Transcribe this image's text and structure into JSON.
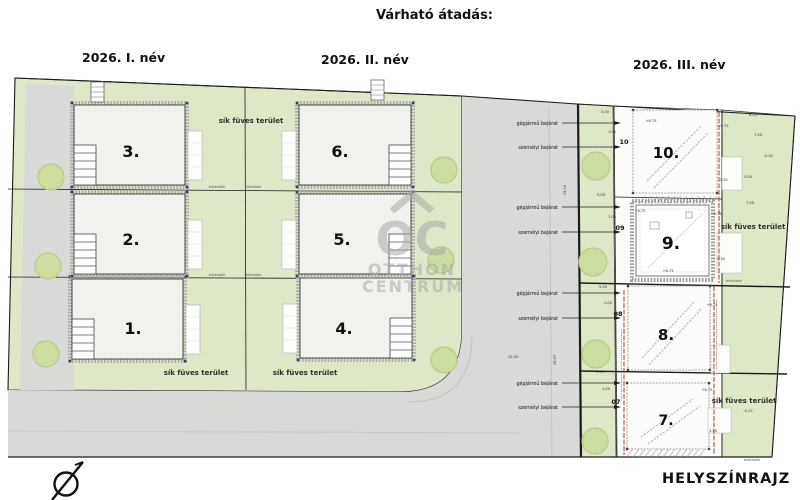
{
  "header": {
    "title": "Várható átadás:",
    "quarters": [
      {
        "label": "2026. I. név"
      },
      {
        "label": "2026. II. név"
      },
      {
        "label": "2026. III. név"
      }
    ]
  },
  "footer": {
    "drawing_type": "HELYSZÍNRAJZ"
  },
  "watermark": {
    "initials": "OC",
    "line1": "OTTHON",
    "line2": "CENTRUM"
  },
  "plan": {
    "grass_label": "sík füves terület",
    "boundary_label": "telekhatár",
    "buildings": [
      {
        "label": "1.",
        "x": 133,
        "y": 334,
        "fs": 16
      },
      {
        "label": "2.",
        "x": 131,
        "y": 245,
        "fs": 16
      },
      {
        "label": "3.",
        "x": 131,
        "y": 157,
        "fs": 16
      },
      {
        "label": "4.",
        "x": 344,
        "y": 334,
        "fs": 16
      },
      {
        "label": "5.",
        "x": 342,
        "y": 245,
        "fs": 16
      },
      {
        "label": "6.",
        "x": 340,
        "y": 157,
        "fs": 16
      },
      {
        "label": "7.",
        "x": 666,
        "y": 425,
        "fs": 14
      },
      {
        "label": "8.",
        "x": 666,
        "y": 340,
        "fs": 15
      },
      {
        "label": "9.",
        "x": 671,
        "y": 249,
        "fs": 17
      },
      {
        "label": "10.",
        "x": 666,
        "y": 158,
        "fs": 15
      }
    ],
    "plot_markers": [
      {
        "label": "10",
        "x": 624,
        "y": 144
      },
      {
        "label": "09",
        "x": 620,
        "y": 230
      },
      {
        "label": "08",
        "x": 618,
        "y": 316
      },
      {
        "label": "07",
        "x": 616,
        "y": 404
      }
    ],
    "entrances": [
      {
        "label": "gépjármű bejárat",
        "y": 123
      },
      {
        "label": "személyi bejárat",
        "y": 147
      },
      {
        "label": "gépjármű bejárat",
        "y": 207
      },
      {
        "label": "személyi bejárat",
        "y": 232
      },
      {
        "label": "gépjármű bejárat",
        "y": 293
      },
      {
        "label": "személyi bejárat",
        "y": 318
      },
      {
        "label": "gépjármű bejárat",
        "y": 383
      },
      {
        "label": "személyi bejárat",
        "y": 407
      }
    ],
    "boundary_labels": [
      {
        "x": 217,
        "y": 188
      },
      {
        "x": 253,
        "y": 188
      },
      {
        "x": 217,
        "y": 276
      },
      {
        "x": 253,
        "y": 276
      },
      {
        "x": 734,
        "y": 282
      },
      {
        "x": 752,
        "y": 461
      }
    ],
    "dimensions": [
      {
        "t": "+6.75",
        "x": 651,
        "y": 122
      },
      {
        "t": "+6.75",
        "x": 723,
        "y": 127
      },
      {
        "t": "+6.75",
        "x": 640,
        "y": 212
      },
      {
        "t": "+6.75",
        "x": 716,
        "y": 215
      },
      {
        "t": "+6.75",
        "x": 668,
        "y": 272
      },
      {
        "t": "+6.75",
        "x": 712,
        "y": 306
      },
      {
        "t": "+6.75",
        "x": 707,
        "y": 391
      },
      {
        "t": "-0.15",
        "x": 768,
        "y": 157
      },
      {
        "t": "-0.15",
        "x": 748,
        "y": 412
      },
      {
        "t": "-3.20",
        "x": 723,
        "y": 181
      },
      {
        "t": "5.00",
        "x": 605,
        "y": 113
      },
      {
        "t": "5.00",
        "x": 601,
        "y": 196
      },
      {
        "t": "5.00",
        "x": 603,
        "y": 288
      },
      {
        "t": "5.00",
        "x": 600,
        "y": 373
      },
      {
        "t": "15.00",
        "x": 566,
        "y": 190,
        "r": -90
      },
      {
        "t": "15.07",
        "x": 556,
        "y": 360,
        "r": -90
      },
      {
        "t": "22.00",
        "x": 513,
        "y": 358
      },
      {
        "t": "8.25",
        "x": 753,
        "y": 116
      },
      {
        "t": "7.50",
        "x": 758,
        "y": 136
      },
      {
        "t": "3.00",
        "x": 748,
        "y": 178
      },
      {
        "t": "7.00",
        "x": 750,
        "y": 204
      },
      {
        "t": "3.20",
        "x": 713,
        "y": 432
      },
      {
        "t": "2.30",
        "x": 721,
        "y": 260
      },
      {
        "t": "1.05",
        "x": 612,
        "y": 133
      },
      {
        "t": "1.05",
        "x": 612,
        "y": 218
      },
      {
        "t": "1.05",
        "x": 608,
        "y": 304
      },
      {
        "t": "1.05",
        "x": 606,
        "y": 390
      }
    ],
    "colors": {
      "grass": "#dce8c8",
      "road": "#d9d9d8",
      "tree": "#cbde9f",
      "tree_edge": "#b6cb85",
      "fence": "#a8543a",
      "outline": "#1c1c1c",
      "building_fill": "#f1f1ee",
      "watermark": "#a9a9a9"
    }
  }
}
